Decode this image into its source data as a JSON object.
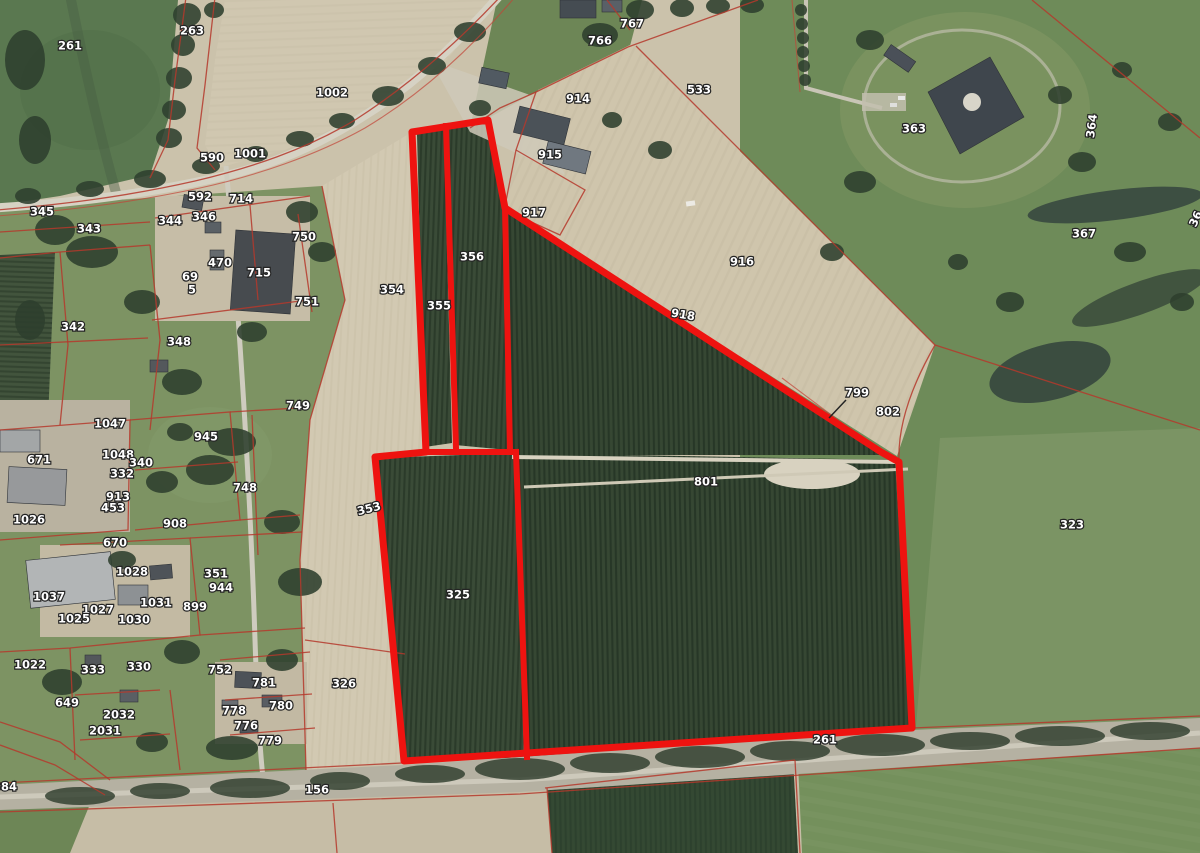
{
  "map": {
    "description": "Aerial photo cadastral viewer: farmland parcels with red boundary lines; a group of orchard parcels is selected with a thick red outline",
    "colors": {
      "selection_outline": "#ee1310",
      "parcel_line": "#b5382c",
      "label_fill": "#ffffff",
      "label_halo": "#242424"
    },
    "leader_line": {
      "label": "799",
      "x1": 846,
      "y1": 400,
      "x2": 829,
      "y2": 418
    },
    "parcel_labels": [
      {
        "t": "261",
        "x": 70,
        "y": 46
      },
      {
        "t": "263",
        "x": 192,
        "y": 31
      },
      {
        "t": "1002",
        "x": 332,
        "y": 93
      },
      {
        "t": "767",
        "x": 632,
        "y": 24
      },
      {
        "t": "766",
        "x": 600,
        "y": 41
      },
      {
        "t": "914",
        "x": 578,
        "y": 99
      },
      {
        "t": "915",
        "x": 550,
        "y": 155
      },
      {
        "t": "533",
        "x": 699,
        "y": 90
      },
      {
        "t": "363",
        "x": 914,
        "y": 129
      },
      {
        "t": "364",
        "x": 1092,
        "y": 126,
        "rot": -83
      },
      {
        "t": "367",
        "x": 1084,
        "y": 234
      },
      {
        "t": "36",
        "x": 1196,
        "y": 219,
        "rot": -65
      },
      {
        "t": "590",
        "x": 212,
        "y": 158
      },
      {
        "t": "1001",
        "x": 250,
        "y": 154
      },
      {
        "t": "592",
        "x": 200,
        "y": 197
      },
      {
        "t": "714",
        "x": 241,
        "y": 199
      },
      {
        "t": "345",
        "x": 42,
        "y": 212
      },
      {
        "t": "343",
        "x": 89,
        "y": 229
      },
      {
        "t": "344",
        "x": 170,
        "y": 221
      },
      {
        "t": "346",
        "x": 204,
        "y": 217
      },
      {
        "t": "750",
        "x": 304,
        "y": 237
      },
      {
        "t": "470",
        "x": 220,
        "y": 263
      },
      {
        "t": "69",
        "x": 190,
        "y": 277
      },
      {
        "t": "5",
        "x": 192,
        "y": 290
      },
      {
        "t": "715",
        "x": 259,
        "y": 273
      },
      {
        "t": "751",
        "x": 307,
        "y": 302
      },
      {
        "t": "342",
        "x": 73,
        "y": 327
      },
      {
        "t": "348",
        "x": 179,
        "y": 342
      },
      {
        "t": "354",
        "x": 392,
        "y": 290
      },
      {
        "t": "355",
        "x": 439,
        "y": 306
      },
      {
        "t": "356",
        "x": 472,
        "y": 257
      },
      {
        "t": "917",
        "x": 534,
        "y": 213
      },
      {
        "t": "916",
        "x": 742,
        "y": 262
      },
      {
        "t": "918",
        "x": 683,
        "y": 315,
        "rot": 10
      },
      {
        "t": "799",
        "x": 857,
        "y": 393
      },
      {
        "t": "802",
        "x": 888,
        "y": 412
      },
      {
        "t": "749",
        "x": 298,
        "y": 406
      },
      {
        "t": "1047",
        "x": 110,
        "y": 424
      },
      {
        "t": "945",
        "x": 206,
        "y": 437
      },
      {
        "t": "671",
        "x": 39,
        "y": 460
      },
      {
        "t": "1048",
        "x": 118,
        "y": 455
      },
      {
        "t": "340",
        "x": 141,
        "y": 463
      },
      {
        "t": "332",
        "x": 122,
        "y": 474
      },
      {
        "t": "913",
        "x": 118,
        "y": 497
      },
      {
        "t": "453",
        "x": 113,
        "y": 508
      },
      {
        "t": "748",
        "x": 245,
        "y": 488
      },
      {
        "t": "1026",
        "x": 29,
        "y": 520
      },
      {
        "t": "908",
        "x": 175,
        "y": 524
      },
      {
        "t": "670",
        "x": 115,
        "y": 543
      },
      {
        "t": "1028",
        "x": 132,
        "y": 572
      },
      {
        "t": "351",
        "x": 216,
        "y": 574
      },
      {
        "t": "944",
        "x": 221,
        "y": 588
      },
      {
        "t": "899",
        "x": 195,
        "y": 607
      },
      {
        "t": "1037",
        "x": 49,
        "y": 597
      },
      {
        "t": "1027",
        "x": 98,
        "y": 610
      },
      {
        "t": "1025",
        "x": 74,
        "y": 619
      },
      {
        "t": "1031",
        "x": 156,
        "y": 603
      },
      {
        "t": "1030",
        "x": 134,
        "y": 620
      },
      {
        "t": "1022",
        "x": 30,
        "y": 665
      },
      {
        "t": "333",
        "x": 93,
        "y": 670
      },
      {
        "t": "330",
        "x": 139,
        "y": 667
      },
      {
        "t": "649",
        "x": 67,
        "y": 703
      },
      {
        "t": "2032",
        "x": 119,
        "y": 715
      },
      {
        "t": "2031",
        "x": 105,
        "y": 731
      },
      {
        "t": "752",
        "x": 220,
        "y": 670
      },
      {
        "t": "781",
        "x": 264,
        "y": 683
      },
      {
        "t": "780",
        "x": 281,
        "y": 706
      },
      {
        "t": "778",
        "x": 234,
        "y": 711
      },
      {
        "t": "776",
        "x": 246,
        "y": 726
      },
      {
        "t": "779",
        "x": 270,
        "y": 741
      },
      {
        "t": "384",
        "x": 5,
        "y": 787
      },
      {
        "t": "326",
        "x": 344,
        "y": 684
      },
      {
        "t": "353",
        "x": 369,
        "y": 509,
        "rot": -14
      },
      {
        "t": "325",
        "x": 458,
        "y": 595
      },
      {
        "t": "156",
        "x": 317,
        "y": 790
      },
      {
        "t": "801",
        "x": 706,
        "y": 482
      },
      {
        "t": "323",
        "x": 1072,
        "y": 525
      },
      {
        "t": "261",
        "x": 825,
        "y": 740
      }
    ]
  }
}
